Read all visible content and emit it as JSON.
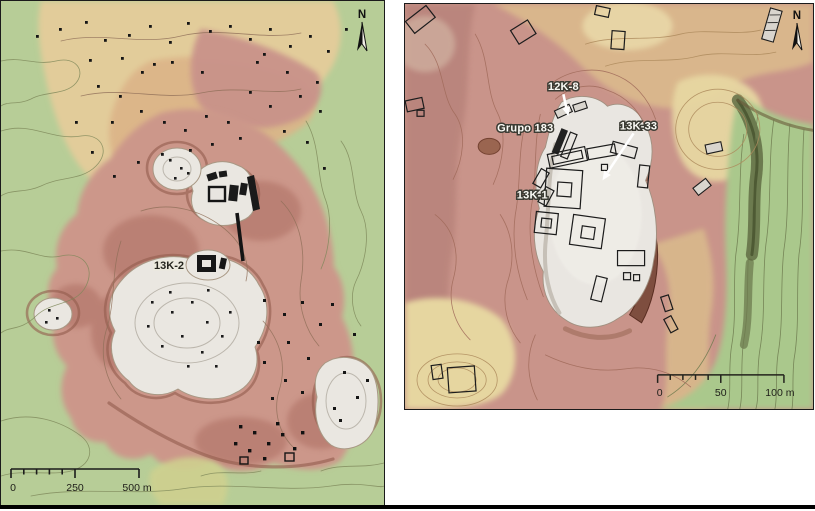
{
  "figure": {
    "description": "Two-panel LiDAR elevation and contour map figure of an archaeological site",
    "colors": {
      "lowland_green": "#b7cd97",
      "terrace_tan": "#e2cc9a",
      "upland_pink": "#cc978a",
      "plateau_white": "#eae7e1",
      "structure_black": "#161616",
      "escarpment_maroon": "#7b4b3c",
      "label_white": "#fbfbf6",
      "label_dark": "#25251e"
    }
  },
  "left_map": {
    "name": "LiDAR overview map",
    "site_label": "13K-2",
    "north_label": "N",
    "scale_bar": {
      "start": "0",
      "mid": "250",
      "end": "500 m"
    }
  },
  "right_map": {
    "name": "LiDAR detail map of site core",
    "labels": {
      "group_12k8": "12K-8",
      "grupo_183": "Grupo 183",
      "group_13k33": "13K-33",
      "group_13k1": "13K-1"
    },
    "north_label": "N",
    "scale_bar": {
      "start": "0",
      "mid": "50",
      "end": "100 m"
    }
  }
}
